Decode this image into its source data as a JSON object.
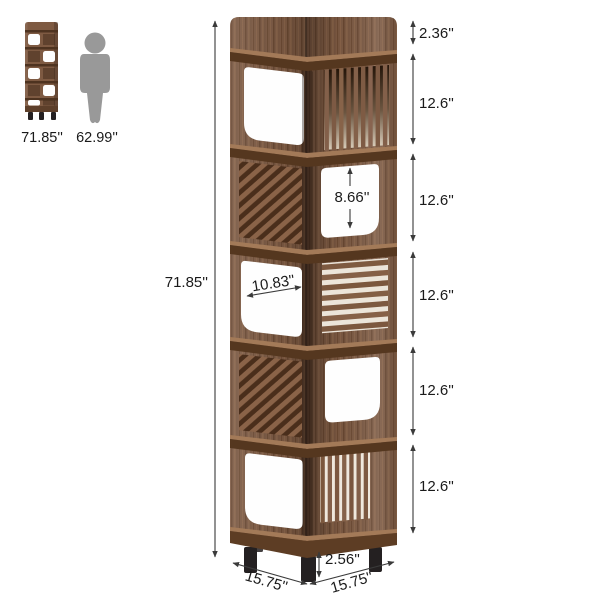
{
  "scale_reference": {
    "shelf_height": "71.85''",
    "person_height": "62.99''"
  },
  "dimensions": {
    "overall_height": "71.85''",
    "top_rim": "2.36''",
    "section_heights": [
      "12.6''",
      "12.6''",
      "12.6''",
      "12.6''",
      "12.6''"
    ],
    "opening_height": "8.66''",
    "shelf_width": "10.83''",
    "leg_height": "2.56''",
    "base_side_left": "15.75''",
    "base_side_right": "15.75''"
  },
  "colors": {
    "wood": "#7d5a43",
    "wood_dark": "#55371f",
    "wood_light": "#a37a58",
    "person_gray": "#999999",
    "leg_black": "#242021",
    "dimension_line": "#3a3a3a",
    "text": "#1a1a1a",
    "background": "#ffffff"
  }
}
